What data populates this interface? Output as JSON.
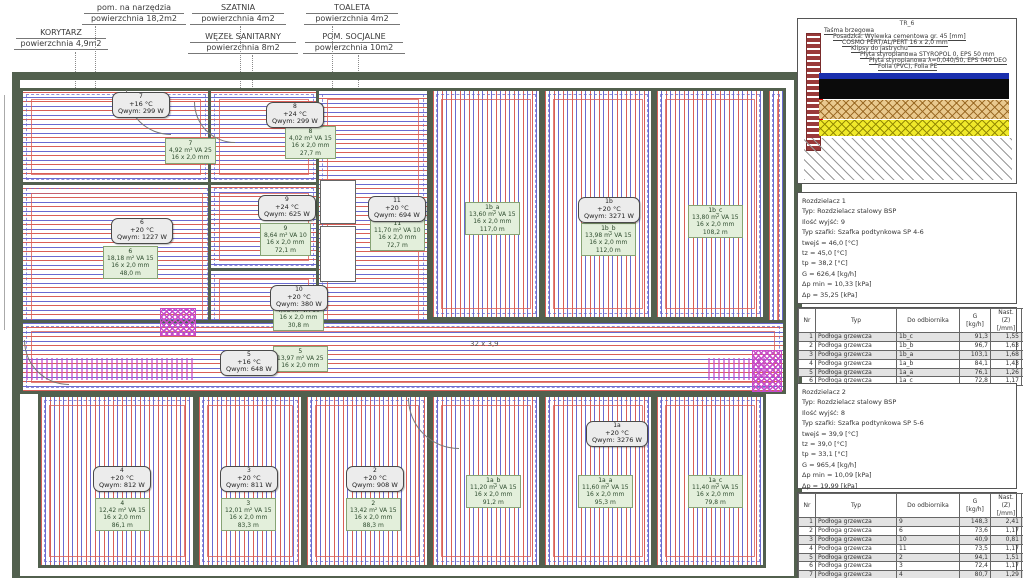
{
  "colors": {
    "wall": "#52604e",
    "pipe_red": "#d95f57",
    "pipe_blue": "#6a6ad0",
    "magenta": "#c84cc8",
    "loopbg": "#e3efdb",
    "brick": "#9a3a3a",
    "dblue": "#1a2fae",
    "dtan": "#e9c98e",
    "dyellow": "#f0e92a"
  },
  "annotations": [
    {
      "title": "KORYTARZ",
      "sub": "powierzchnia 4,9m2",
      "x": 14,
      "y": 28,
      "w": 90
    },
    {
      "title": "pom. na narzędzia",
      "sub": "powierzchnia 18,2m2",
      "x": 82,
      "y": 3,
      "w": 100
    },
    {
      "title": "SZATNIA",
      "sub": "powierzchnia 4m2",
      "x": 190,
      "y": 3,
      "w": 92
    },
    {
      "title": "WĘZEŁ SANITARNY",
      "sub": "powierzchnia 8m2",
      "x": 188,
      "y": 32,
      "w": 106
    },
    {
      "title": "TOALETA",
      "sub": "powierzchnia 4m2",
      "x": 304,
      "y": 3,
      "w": 92
    },
    {
      "title": "POM. SOCJALNE",
      "sub": "powierzchnia 10m2",
      "x": 303,
      "y": 32,
      "w": 98
    }
  ],
  "plan": {
    "corridor_dim_label": "32 x 3,9",
    "room_labels": [
      {
        "num": "7",
        "temp": "+16 °C",
        "power": "Qwym: 299 W",
        "x": 104,
        "y": 34
      },
      {
        "num": "8",
        "temp": "+24 °C",
        "power": "Qwym: 299 W",
        "x": 258,
        "y": 44
      },
      {
        "num": "6",
        "temp": "+20 °C",
        "power": "Qwym: 1227 W",
        "x": 103,
        "y": 160
      },
      {
        "num": "9",
        "temp": "+24 °C",
        "power": "Qwym: 625 W",
        "x": 250,
        "y": 137
      },
      {
        "num": "11",
        "temp": "+20 °C",
        "power": "Qwym: 694 W",
        "x": 360,
        "y": 138
      },
      {
        "num": "1b",
        "temp": "+20 °C",
        "power": "Qwym: 3271 W",
        "x": 570,
        "y": 139
      },
      {
        "num": "10",
        "temp": "+20 °C",
        "power": "Qwym: 380 W",
        "x": 262,
        "y": 227
      },
      {
        "num": "5",
        "temp": "+16 °C",
        "power": "Qwym: 648 W",
        "x": 212,
        "y": 292
      },
      {
        "num": "4",
        "temp": "+20 °C",
        "power": "Qwym: 812 W",
        "x": 85,
        "y": 408
      },
      {
        "num": "3",
        "temp": "+20 °C",
        "power": "Qwym: 811 W",
        "x": 212,
        "y": 408
      },
      {
        "num": "2",
        "temp": "+20 °C",
        "power": "Qwym: 908 W",
        "x": 338,
        "y": 408
      },
      {
        "num": "1a",
        "temp": "+20 °C",
        "power": "Qwym: 3276 W",
        "x": 578,
        "y": 363
      }
    ],
    "loop_boxes": [
      {
        "id": "7",
        "lines": [
          "4,92 m² VA 25",
          "16 x 2,0 mm"
        ],
        "x": 157,
        "y": 80
      },
      {
        "id": "8",
        "lines": [
          "4,02 m² VA 15",
          "16 x 2,0 mm",
          "27,7 m"
        ],
        "x": 277,
        "y": 68
      },
      {
        "id": "6",
        "lines": [
          "18,18 m² VA 15",
          "16 x 2,0 mm",
          "48,0 m"
        ],
        "x": 95,
        "y": 188
      },
      {
        "id": "9",
        "lines": [
          "8,64 m² VA 10",
          "16 x 2,0 mm",
          "72,1 m"
        ],
        "x": 252,
        "y": 165
      },
      {
        "id": "11",
        "lines": [
          "11,70 m² VA 10",
          "16 x 2,0 mm",
          "72,7 m"
        ],
        "x": 362,
        "y": 160
      },
      {
        "id": "1b_a",
        "lines": [
          "13,60 m² VA 15",
          "16 x 2,0 mm",
          "117,0 m"
        ],
        "x": 457,
        "y": 144
      },
      {
        "id": "1b_b",
        "lines": [
          "13,98 m² VA 15",
          "16 x 2,0 mm",
          "112,0 m"
        ],
        "x": 573,
        "y": 165
      },
      {
        "id": "1b_c",
        "lines": [
          "13,80 m² VA 15",
          "16 x 2,0 mm",
          "108,2 m"
        ],
        "x": 680,
        "y": 147
      },
      {
        "id": "10",
        "lines": [
          "4,08 m² VA 10",
          "16 x 2,0 mm",
          "30,8 m"
        ],
        "x": 265,
        "y": 240
      },
      {
        "id": "5",
        "lines": [
          "13,97 m² VA 25",
          "16 x 2,0 mm"
        ],
        "x": 265,
        "y": 288
      },
      {
        "id": "4",
        "lines": [
          "12,42 m² VA 15",
          "16 x 2,0 mm",
          "86,1 m"
        ],
        "x": 87,
        "y": 440
      },
      {
        "id": "3",
        "lines": [
          "12,01 m² VA 15",
          "16 x 2,0 mm",
          "83,3 m"
        ],
        "x": 213,
        "y": 440
      },
      {
        "id": "2",
        "lines": [
          "13,42 m² VA 15",
          "16 x 2,0 mm",
          "88,3 m"
        ],
        "x": 338,
        "y": 440
      },
      {
        "id": "1a_b",
        "lines": [
          "11,20 m² VA 15",
          "16 x 2,0 mm",
          "91,2 m"
        ],
        "x": 458,
        "y": 417
      },
      {
        "id": "1a_a",
        "lines": [
          "11,60 m² VA 15",
          "16 x 2,0 mm",
          "95,3 m"
        ],
        "x": 570,
        "y": 417
      },
      {
        "id": "1a_c",
        "lines": [
          "11,40 m² VA 15",
          "16 x 2,0 mm",
          "79,8 m"
        ],
        "x": 680,
        "y": 417
      }
    ]
  },
  "detail": {
    "title": "TR_6",
    "layer_labels": [
      "Taśma brzegowa",
      "Posadzka: Wylewka cementowa gr. 45 [mm]",
      "COSMO PERT/AL/PERT 16 x 2,0 mm",
      "Klipsy do jastrychu",
      "Płyta styropianowa STYROPOL 0, EPS 50 mm",
      "Płyta styropianowa λ=0,040/50, EPS 040 DEO",
      "Folia (PVC), Folia PE"
    ]
  },
  "manifold1": {
    "lines": [
      "Rozdzielacz 1",
      "Typ: Rozdzielacz stalowy BSP",
      "Ilość wyjść: 9",
      "Typ szafki: Szafka podtynkowa SP 4-6",
      "twejś = 46,0 [°C]",
      "tz = 45,0 [°C]",
      "tp = 38,2 [°C]",
      "G = 626,4 [kg/h]",
      "Δp min = 10,33 [kPa]",
      "Δp = 35,25 [kPa]"
    ]
  },
  "manifold2": {
    "lines": [
      "Rozdzielacz 2",
      "Typ: Rozdzielacz stalowy BSP",
      "Ilość wyjść: 8",
      "Typ szafki: Szafka podtynkowa SP 5-6",
      "twejś = 39,9 [°C]",
      "tz = 39,0 [°C]",
      "tp = 33,1 [°C]",
      "G = 965,4 [kg/h]",
      "Δp min = 10,09 [kPa]",
      "Δp = 19,99 [kPa]"
    ]
  },
  "loop_table_header": [
    "Nr",
    "Typ",
    "Do odbiornika",
    "G\n[kg/h]",
    "Nast. (Z)\n[/mm]",
    "Δp (P)\n[kPa]"
  ],
  "table1_rows": [
    [
      "1",
      "Podłoga grzewcza",
      "1b_c",
      "91,3",
      "1,55",
      "0,69"
    ],
    [
      "2",
      "Podłoga grzewcza",
      "1b_b",
      "96,7",
      "1,63",
      "0,78"
    ],
    [
      "3",
      "Podłoga grzewcza",
      "1b_a",
      "103,1",
      "1,68",
      "0,87"
    ],
    [
      "4",
      "Podłoga grzewcza",
      "1a_b",
      "84,1",
      "1,43",
      "0,58"
    ],
    [
      "5",
      "Podłoga grzewcza",
      "1a_a",
      "76,1",
      "1,26",
      "0,51"
    ],
    [
      "6",
      "Podłoga grzewcza",
      "1a_c",
      "72,8",
      "1,17",
      "0,44"
    ]
  ],
  "table2_rows": [
    [
      "1",
      "Podłoga grzewcza",
      "9",
      "148,3",
      "2,41",
      "1,84"
    ],
    [
      "2",
      "Podłoga grzewcza",
      "6",
      "73,6",
      "1,17",
      "0,45"
    ],
    [
      "3",
      "Podłoga grzewcza",
      "10",
      "40,9",
      "0,81",
      "0,14"
    ],
    [
      "4",
      "Podłoga grzewcza",
      "11",
      "73,5",
      "1,17",
      "0,45"
    ],
    [
      "5",
      "Podłoga grzewcza",
      "2",
      "94,1",
      "1,51",
      "0,74"
    ],
    [
      "6",
      "Podłoga grzewcza",
      "3",
      "72,4",
      "1,17",
      "0,44"
    ],
    [
      "7",
      "Podłoga grzewcza",
      "4",
      "80,7",
      "1,29",
      "0,57"
    ],
    [
      "8",
      "Podłoga grzewcza",
      "5",
      "79,9",
      "1,28",
      "0,53"
    ]
  ]
}
